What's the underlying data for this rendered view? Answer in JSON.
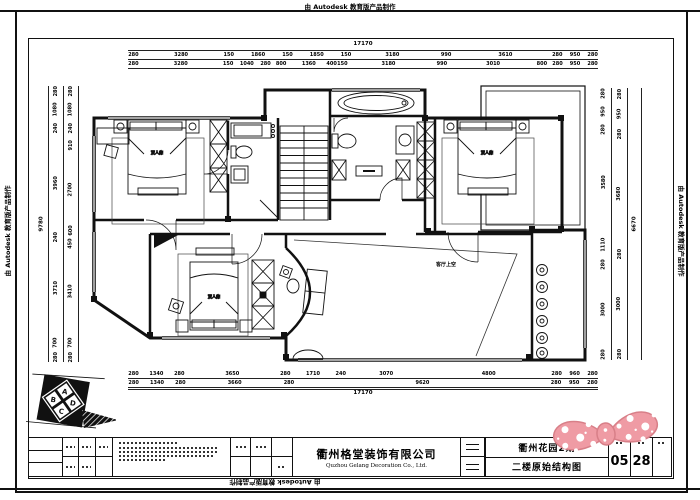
{
  "banner": "由 Autodesk 教育版产品制作",
  "dims": {
    "top": {
      "overall": "17170",
      "row1": [
        "280",
        "3280",
        "150",
        "1860",
        "150",
        "1850",
        "150",
        "3180",
        "990",
        "3610",
        "280",
        "950",
        "280"
      ],
      "row2": [
        "280",
        "3280",
        "150",
        "1040",
        "280",
        "800",
        "1360",
        "400",
        "150",
        "3180",
        "990",
        "3010",
        "800",
        "280",
        "950",
        "280"
      ]
    },
    "bottom": {
      "row1": [
        "280",
        "1340",
        "280",
        "3650",
        "280",
        "1710",
        "240",
        "3070",
        "4800",
        "280",
        "960",
        "280"
      ],
      "row2": [
        "280",
        "1340",
        "280",
        "3660",
        "280",
        "9620",
        "280",
        "950",
        "280"
      ],
      "overall": "17170"
    },
    "left": {
      "overall": "9780",
      "mid": [
        "280",
        "1080",
        "240",
        "3960",
        "240",
        "3710",
        "700",
        "280"
      ],
      "inner": [
        "280",
        "1080",
        "240",
        "910",
        "2700",
        "600",
        "450",
        "3410",
        "700",
        "280"
      ]
    },
    "right": {
      "inner": [
        "280",
        "950",
        "280",
        "3580",
        "1110",
        "280",
        "3000",
        "280"
      ],
      "outer": [
        "280",
        "950",
        "280",
        "3680",
        "280",
        "3000",
        "280"
      ],
      "overall": "6670"
    }
  },
  "plan": {
    "labels": {
      "void": "客厅上空",
      "bed": "双人床"
    }
  },
  "compass": {
    "letters": [
      "A",
      "D",
      "C",
      "B"
    ]
  },
  "title_block": {
    "company_cn": "衢州格堂装饰有限公司",
    "company_en": "Quzhou Gelang Decoration Co., Ltd.",
    "project": "衢州花园2期",
    "drawing_title": "二楼原始结构图",
    "sheet_no": "05",
    "sheet_total": "28"
  },
  "colors": {
    "bowtie": "#ef9ba4",
    "bowtie_edge": "#d87f88",
    "ink": "#111111"
  }
}
